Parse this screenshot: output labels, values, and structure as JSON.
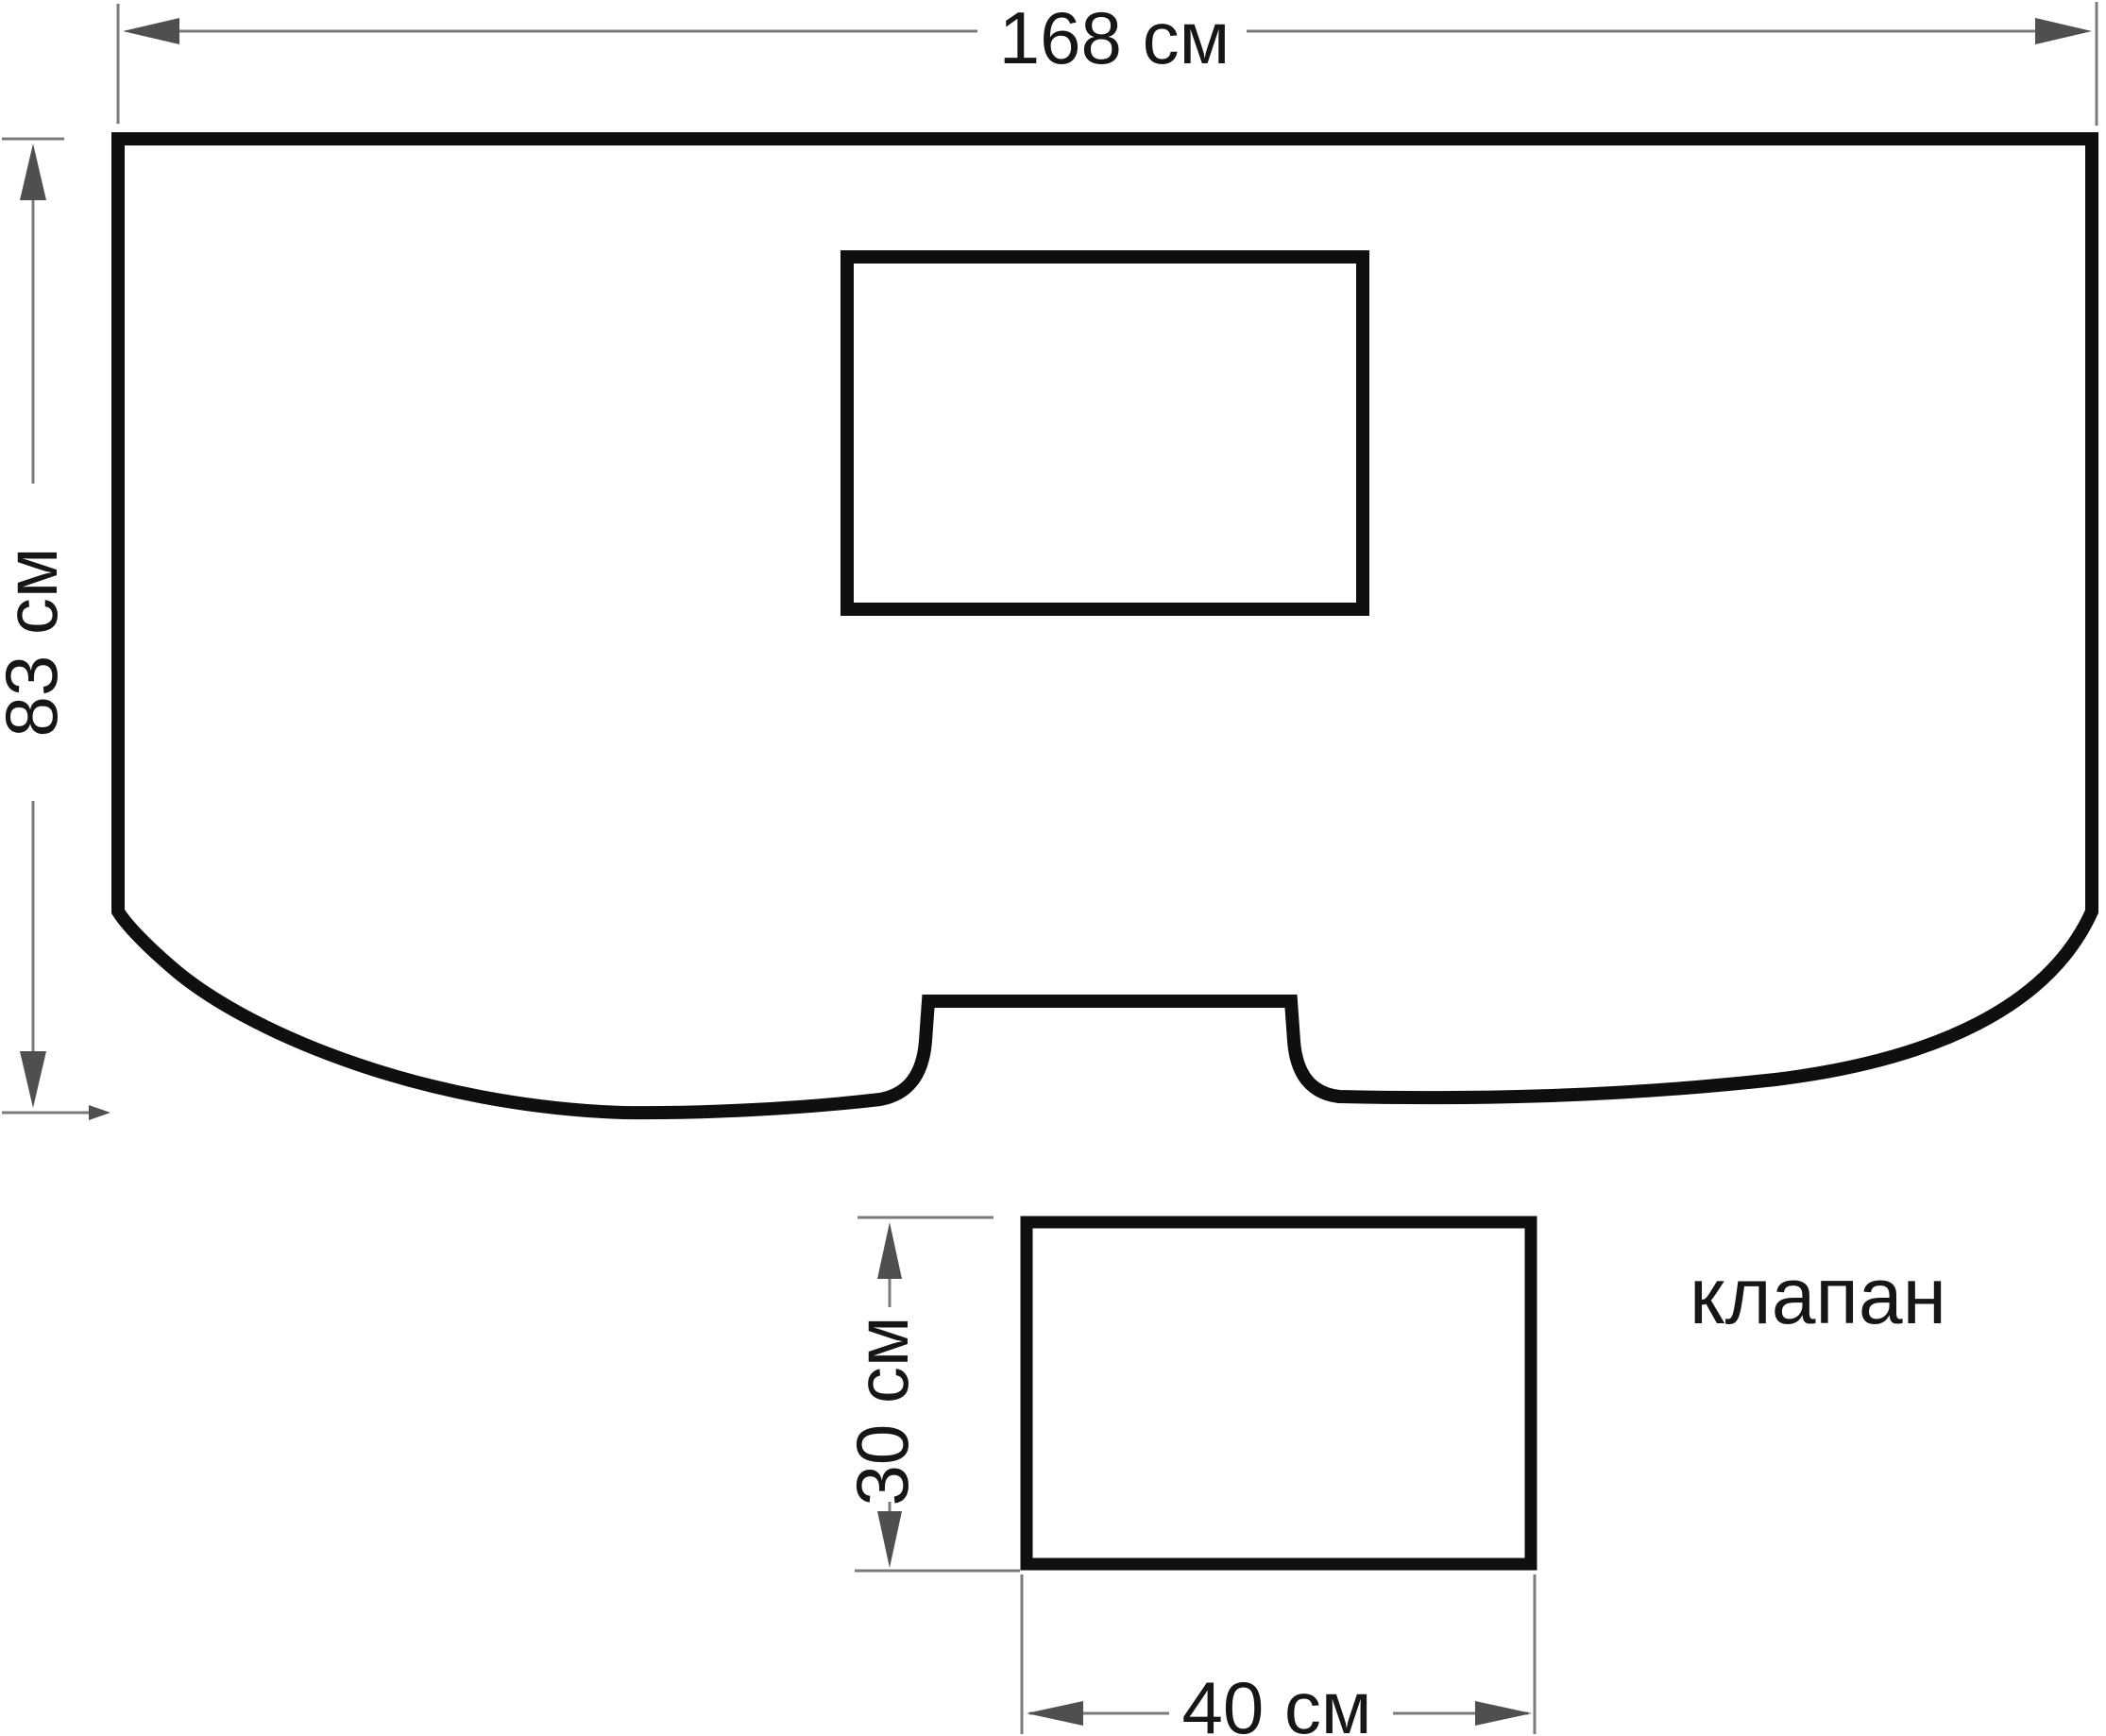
{
  "diagram": {
    "main_piece": {
      "width_label": "168 см",
      "height_label": "83 см"
    },
    "flap_piece": {
      "name_label": "клапан",
      "height_label": "30 см",
      "width_label": "40 см"
    },
    "colors": {
      "outline": "#0f0f0f",
      "dimension_line": "#7b7b7b",
      "arrowhead": "#4f4f4f",
      "label_text": "#161616",
      "background": "#ffffff"
    }
  }
}
